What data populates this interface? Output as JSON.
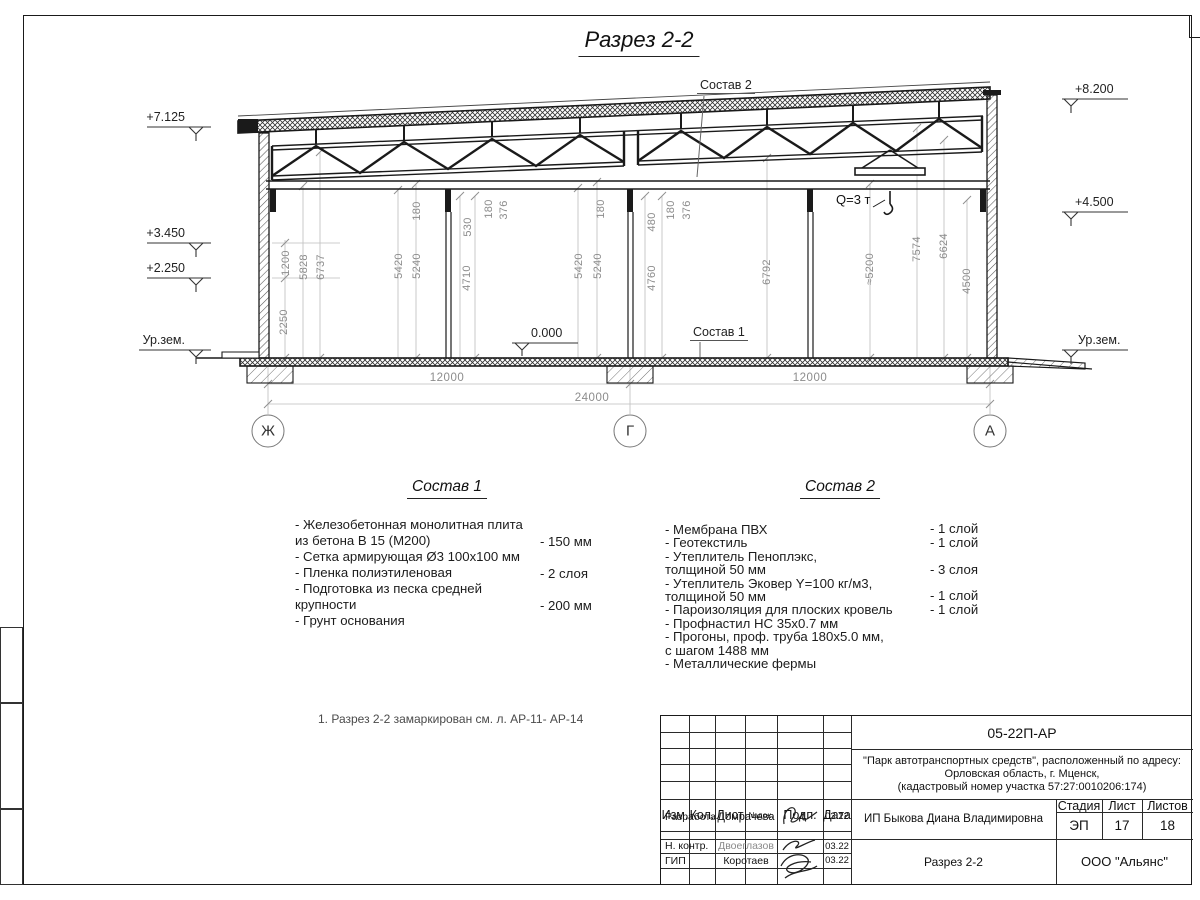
{
  "title": "Разрез 2-2",
  "elevations": {
    "left": [
      "+7.125",
      "+3.450",
      "+2.250",
      "Ур.зем."
    ],
    "right": [
      "+8.200",
      "+4.500",
      "Ур.зем."
    ],
    "zero": "0.000"
  },
  "dims": {
    "vertical": [
      "2250",
      "1200",
      "5828",
      "6737",
      "5420",
      "5240",
      "180",
      "530",
      "180",
      "376",
      "5420",
      "5240",
      "180",
      "480",
      "180",
      "376",
      "4710",
      "4760",
      "6792",
      "≈5200",
      "7574",
      "6624",
      "4500"
    ],
    "horizontal": [
      "12000",
      "12000",
      "24000"
    ]
  },
  "axes": [
    "Ж",
    "Г",
    "А"
  ],
  "labels": {
    "sostav1": "Состав 1",
    "sostav2": "Состав 2",
    "crane": "Q=3 т"
  },
  "compositions": {
    "c1": {
      "title": "Состав 1",
      "items": [
        {
          "text": "- Железобетонная  монолитная плита\n  из бетона В 15 (М200)",
          "value": "- 150 мм"
        },
        {
          "text": "- Сетка армирующая Ø3 100х100 мм",
          "value": ""
        },
        {
          "text": "- Пленка полиэтиленовая",
          "value": "-  2 слоя"
        },
        {
          "text": "- Подготовка из песка средней\n  крупности",
          "value": "- 200 мм"
        },
        {
          "text": "- Грунт основания",
          "value": ""
        }
      ]
    },
    "c2": {
      "title": "Состав 2",
      "items": [
        {
          "text": "- Мембрана ПВХ",
          "value": "- 1 слой"
        },
        {
          "text": "- Геотекстиль",
          "value": "- 1 слой"
        },
        {
          "text": "- Утеплитель Пеноплэкс,\n  толщиной 50 мм",
          "value": "- 3 слоя"
        },
        {
          "text": "- Утеплитель Эковер Y=100 кг/м3,\n  толщиной 50 мм",
          "value": "- 1 слой"
        },
        {
          "text": "- Пароизоляция для плоских кровель",
          "value": "- 1 слой"
        },
        {
          "text": "- Профнастил НС 35х0.7 мм",
          "value": ""
        },
        {
          "text": "- Прогоны, проф. труба 180х5.0 мм,\n  с шагом 1488 мм",
          "value": ""
        },
        {
          "text": "- Металлические фермы",
          "value": ""
        }
      ]
    }
  },
  "note": "1. Разрез 2-2 замаркирован см. л. АР-11- АР-14",
  "titleblock": {
    "doc_number": "05-22П-АР",
    "project": "\"Парк автотранспортных средств\",  расположенный по адресу:\nОрловская область, г. Мценск,\n(кадастровый номер участка 57:27:0010206:174)",
    "client": "ИП Быкова Диана Владимировна",
    "drawing_title": "Разрез 2-2",
    "company": "ООО \"Альянс\"",
    "columns": [
      "Изм.",
      "Кол.",
      "Лист",
      "№док.",
      "Подп.",
      "Дата"
    ],
    "rows": [
      {
        "role": "Разработал",
        "name": "Домрачева",
        "date": "03.22"
      },
      {
        "role": "Н. контр.",
        "name": "Двоеглазов",
        "date": "03.22"
      },
      {
        "role": "ГИП",
        "name": "Коротаев",
        "date": "03.22"
      }
    ],
    "stage_header": [
      "Стадия",
      "Лист",
      "Листов"
    ],
    "stage_values": [
      "ЭП",
      "17",
      "18"
    ]
  }
}
